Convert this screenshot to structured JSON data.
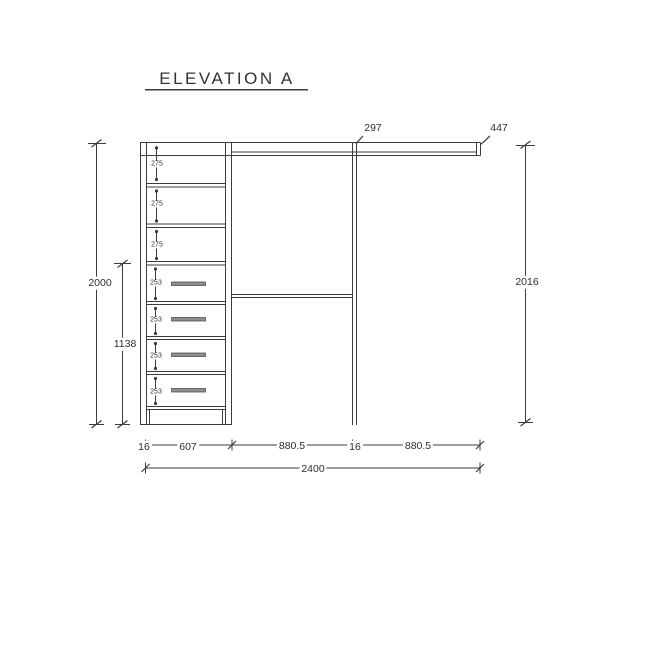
{
  "title": "ELEVATION A",
  "dims": {
    "top_297": "297",
    "top_447": "447",
    "left_total": "2000",
    "left_drawers": "1138",
    "right_total": "2016",
    "shelf": [
      "275",
      "275",
      "275"
    ],
    "drawer": [
      "253",
      "253",
      "253",
      "253"
    ],
    "bottom": [
      "16",
      "607",
      "880.5",
      "16",
      "880.5"
    ],
    "bottom_total": "2400"
  },
  "colors": {
    "line": "#3c3c3c",
    "text": "#2e2e2e",
    "handle": "#8e8e8e",
    "background": "#ffffff"
  }
}
